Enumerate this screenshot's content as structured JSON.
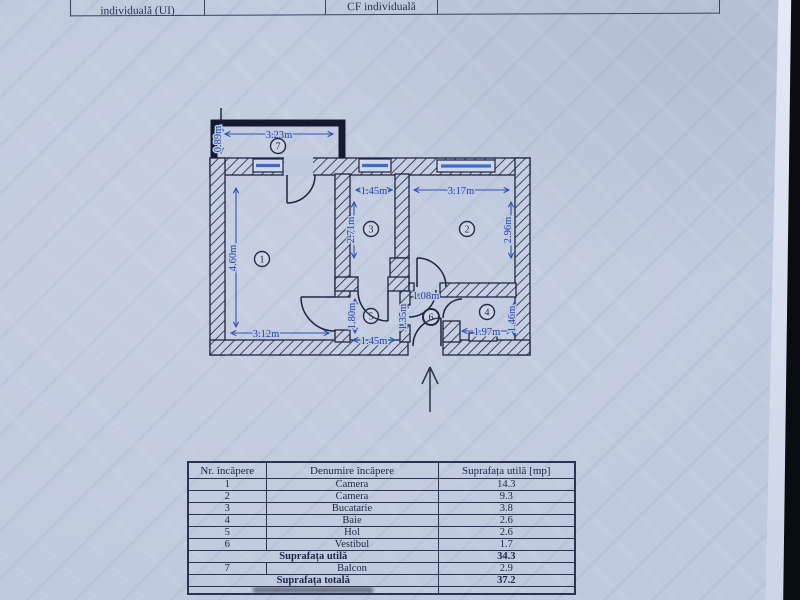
{
  "colors": {
    "paper": "#c0cade",
    "plan_ink": "#1e2642",
    "dimension_blue": "#2b52b8",
    "photo_background": "#0b0c10"
  },
  "top_table": {
    "cells": [
      {
        "label": "individuală (UI)"
      },
      {
        "label": ""
      },
      {
        "label": "CF individuală"
      },
      {
        "label": ""
      }
    ]
  },
  "plan": {
    "north_arrow_icon": "up-arrow",
    "room_numbers": {
      "r1": "1",
      "r2": "2",
      "r3": "3",
      "r4": "4",
      "r5": "5",
      "r6": "6",
      "r7": "7"
    },
    "dims": {
      "balcony_w": "3.23m",
      "balcony_h": "0.89m",
      "room1_h": "4.60m",
      "room1_w": "3.12m",
      "kitchen_w": "1.45m",
      "kitchen_h": "2.71m",
      "room2_w": "3.17m",
      "room2_h": "2.96m",
      "hall_h": "1.80m",
      "hall_w": "1.45m",
      "vestibule_w": "1.08m",
      "vestibule_h": "1.35m",
      "bath_w": "1.97m",
      "bath_h": "1.46m"
    }
  },
  "area_table": {
    "headers": [
      "Nr. încăpere",
      "Denumire încăpere",
      "Suprafața utilă [mp]"
    ],
    "rows": [
      {
        "nr": "1",
        "name": "Camera",
        "area": "14.3"
      },
      {
        "nr": "2",
        "name": "Camera",
        "area": "9.3"
      },
      {
        "nr": "3",
        "name": "Bucatarie",
        "area": "3.8"
      },
      {
        "nr": "4",
        "name": "Baie",
        "area": "2.6"
      },
      {
        "nr": "5",
        "name": "Hol",
        "area": "2.6"
      },
      {
        "nr": "6",
        "name": "Vestibul",
        "area": "1.7"
      }
    ],
    "subtotal": {
      "label": "Suprafața utilă",
      "value": "34.3"
    },
    "balcony": {
      "nr": "7",
      "name": "Balcon",
      "area": "2.9"
    },
    "total": {
      "label": "Suprafața totală",
      "value": "37.2"
    }
  }
}
